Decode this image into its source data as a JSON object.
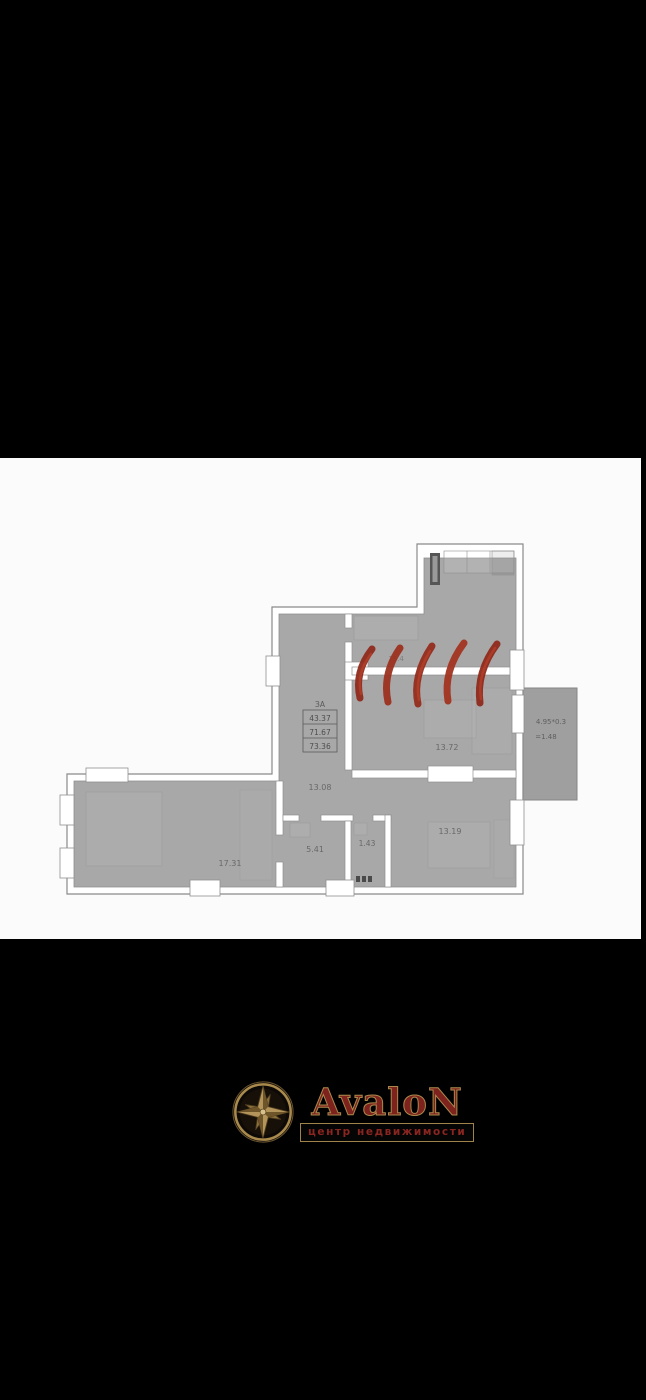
{
  "plan": {
    "stamp": {
      "type": "ЗА",
      "area1": "43.37",
      "area2": "71.67",
      "area3": "73.36"
    },
    "labels": {
      "room_top_partial": "15.4",
      "living": "13.72",
      "hall": "13.08",
      "bedroom_left": "17.31",
      "bath": "5.41",
      "wc": "1.43",
      "bedroom_right": "13.19"
    },
    "balcony": {
      "line1": "4.95*0.3",
      "line2": "=1.48"
    },
    "colors": {
      "room_fill": "#a8a8a8",
      "wall_line": "#8a8a8a",
      "demolition_mark_red": "#9c2f1f"
    }
  },
  "logo": {
    "brand": "AvaloN",
    "tagline": "центр недвижимости",
    "colors": {
      "gold": "#a98a4c",
      "dark_red": "#7e221d"
    }
  }
}
